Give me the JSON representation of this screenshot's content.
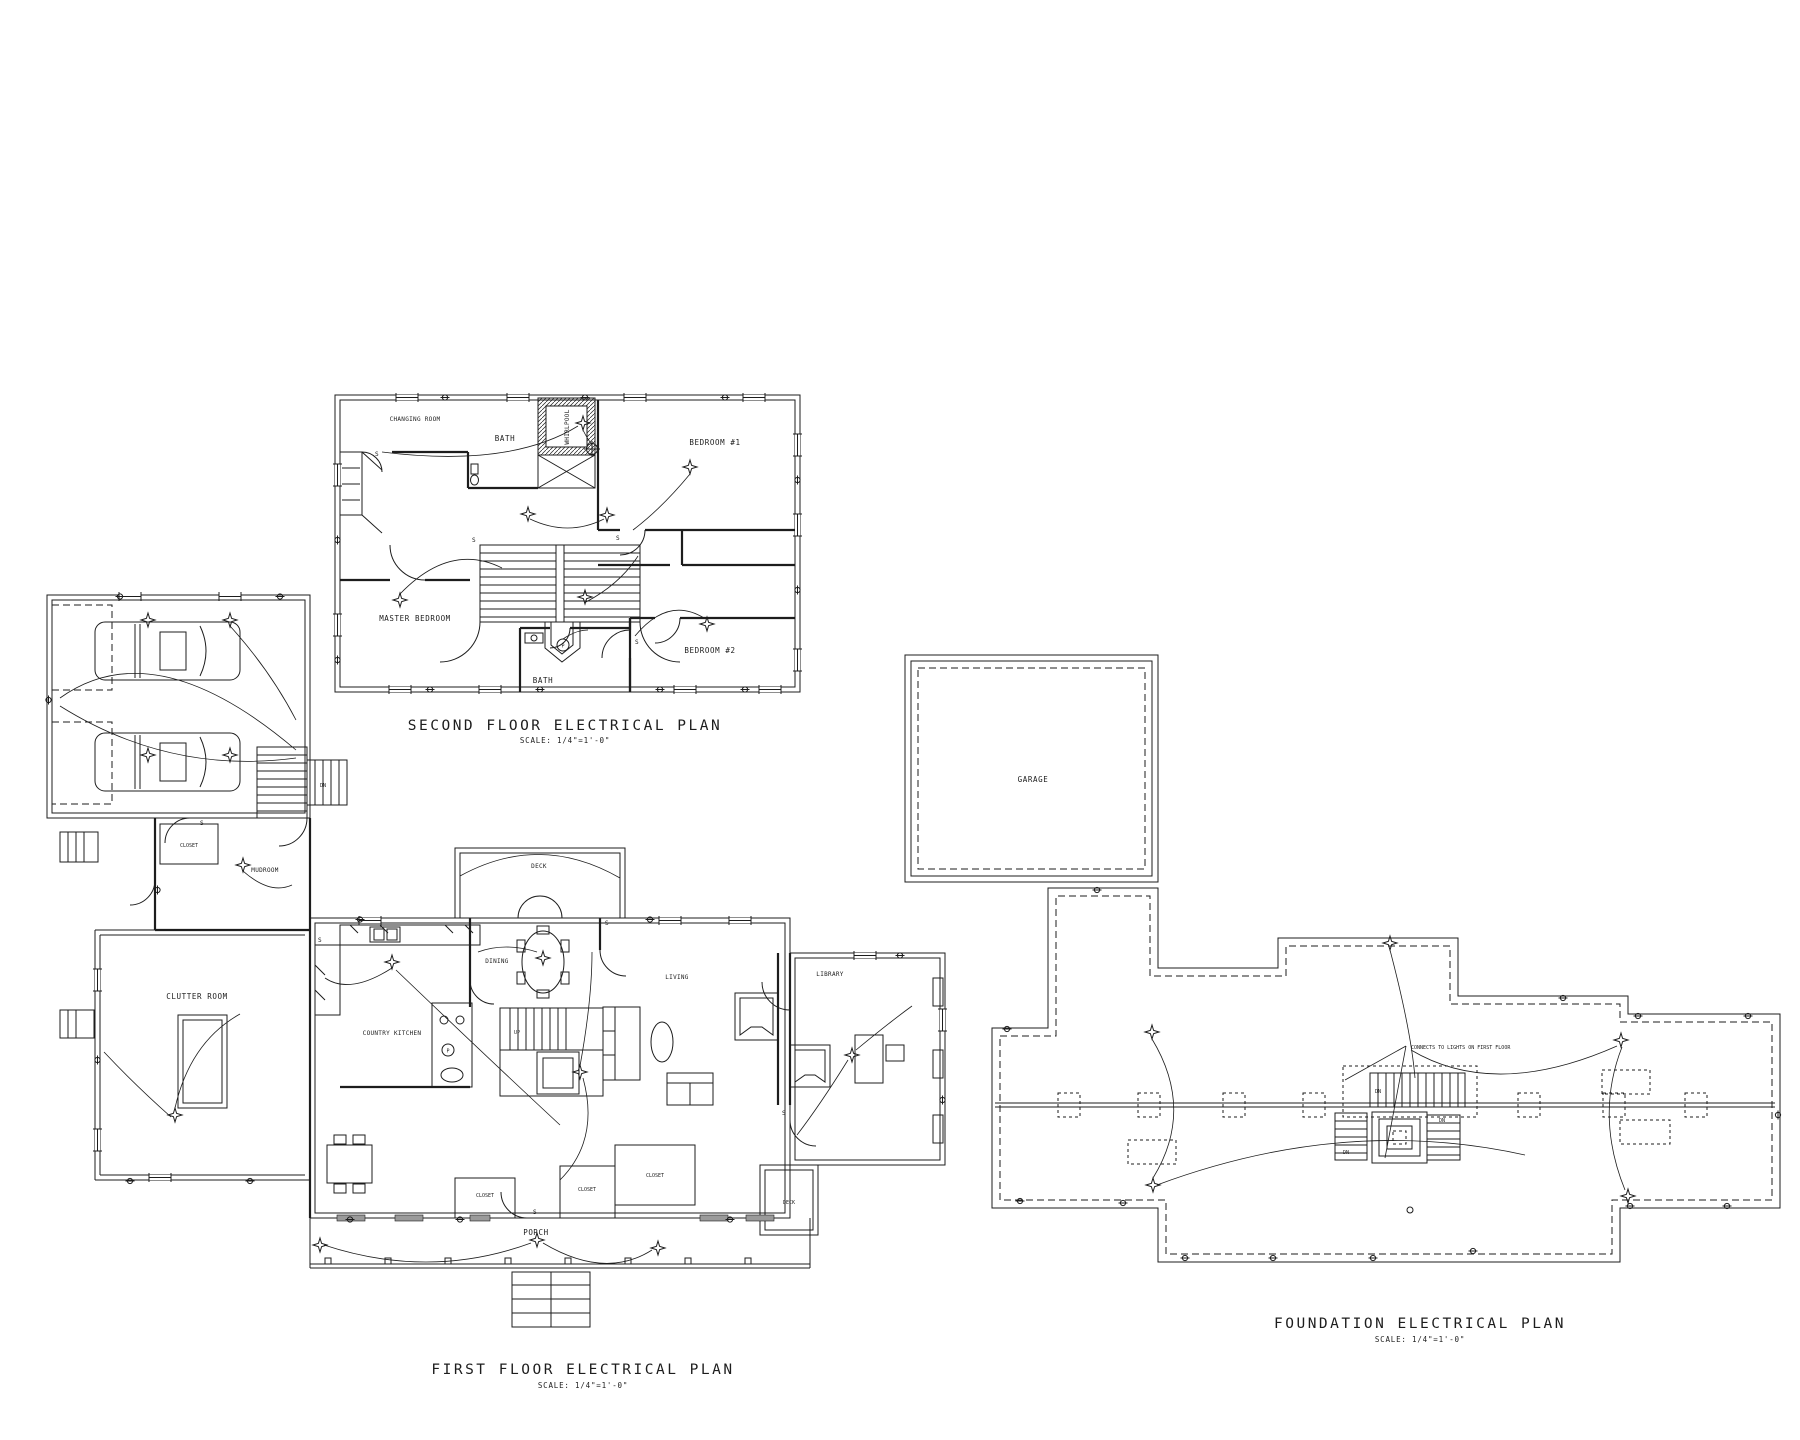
{
  "sheet": {
    "background": "#ffffff",
    "ink": "#1d1d1d"
  },
  "titles": {
    "second_floor": {
      "title": "SECOND FLOOR ELECTRICAL PLAN",
      "scale": "SCALE: 1/4\"=1'-0\""
    },
    "first_floor": {
      "title": "FIRST FLOOR ELECTRICAL PLAN",
      "scale": "SCALE: 1/4\"=1'-0\""
    },
    "foundation": {
      "title": "FOUNDATION ELECTRICAL PLAN",
      "scale": "SCALE: 1/4\"=1'-0\""
    }
  },
  "second_floor_rooms": {
    "changing_room": "CHANGING ROOM",
    "bath_upper": "BATH",
    "whirlpool": "WHIRLPOOL",
    "bedroom_1": "BEDROOM #1",
    "master_bedroom": "MASTER BEDROOM",
    "bath_lower": "BATH",
    "bedroom_2": "BEDROOM #2"
  },
  "first_floor_rooms": {
    "mudroom": "MUDROOM",
    "clutter_room": "CLUTTER ROOM",
    "country_kitchen": "COUNTRY KITCHEN",
    "dining": "DINING",
    "deck_upper": "DECK",
    "living": "LIVING",
    "library": "LIBRARY",
    "porch": "PORCH",
    "deck_side": "DECK",
    "closet": "CLOSET"
  },
  "foundation_rooms": {
    "garage": "GARAGE"
  },
  "notes": {
    "connects_note": "CONNECTS TO LIGHTS ON FIRST FLOOR"
  },
  "stair_labels": {
    "up": "UP",
    "dn": "DN"
  },
  "symbols": {
    "switch": "S",
    "fan": "P"
  }
}
